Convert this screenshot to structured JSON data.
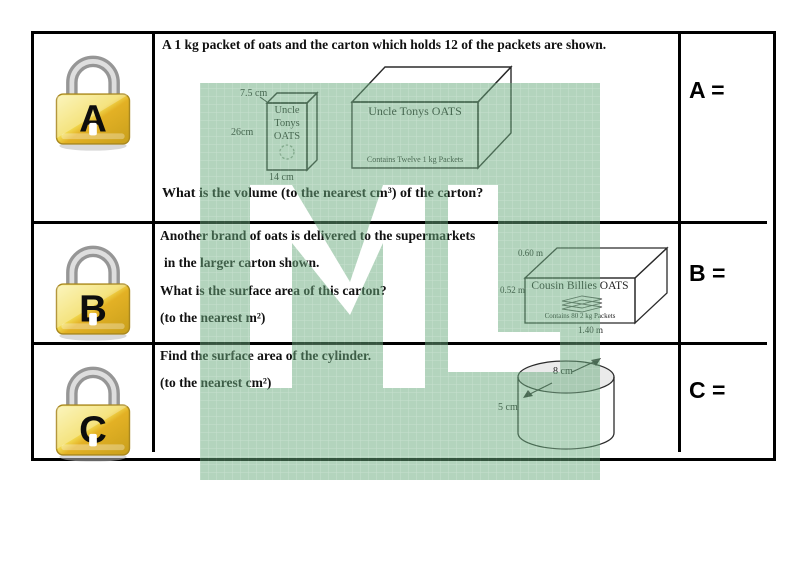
{
  "watermark": {
    "text": "ML",
    "fill": "#67a97b",
    "grid_line": "#8fc19e",
    "opacity": 0.5
  },
  "rows": [
    {
      "lock_letter": "A",
      "answer_label": "A =",
      "intro": "A 1 kg packet of oats and the carton which holds 12 of the packets are shown.",
      "question": "What is the volume (to the nearest cm³) of the carton?",
      "packet": {
        "name_lines": [
          "Uncle",
          "Tonys",
          "OATS"
        ],
        "depth_label": "7.5 cm",
        "height_label": "26cm",
        "width_label": "14 cm"
      },
      "carton": {
        "title": "Uncle Tonys OATS",
        "note": "Contains Twelve 1 kg Packets"
      }
    },
    {
      "lock_letter": "B",
      "answer_label": "B =",
      "lines": [
        "Another brand of oats is delivered to the supermarkets",
        "in the larger carton shown.",
        "What is the surface area of this carton?",
        "(to the nearest m²)"
      ],
      "carton": {
        "title": "Cousin Billies OATS",
        "note": "Contains 80 2 kg Packets",
        "depth_label": "0.60 m",
        "height_label": "0.52 m",
        "width_label": "1.40 m"
      }
    },
    {
      "lock_letter": "C",
      "answer_label": "C =",
      "lines": [
        "Find the surface area of the cylinder.",
        "(to the nearest cm²)"
      ],
      "cylinder": {
        "diameter_label": "8 cm",
        "height_label": "5 cm"
      }
    }
  ]
}
